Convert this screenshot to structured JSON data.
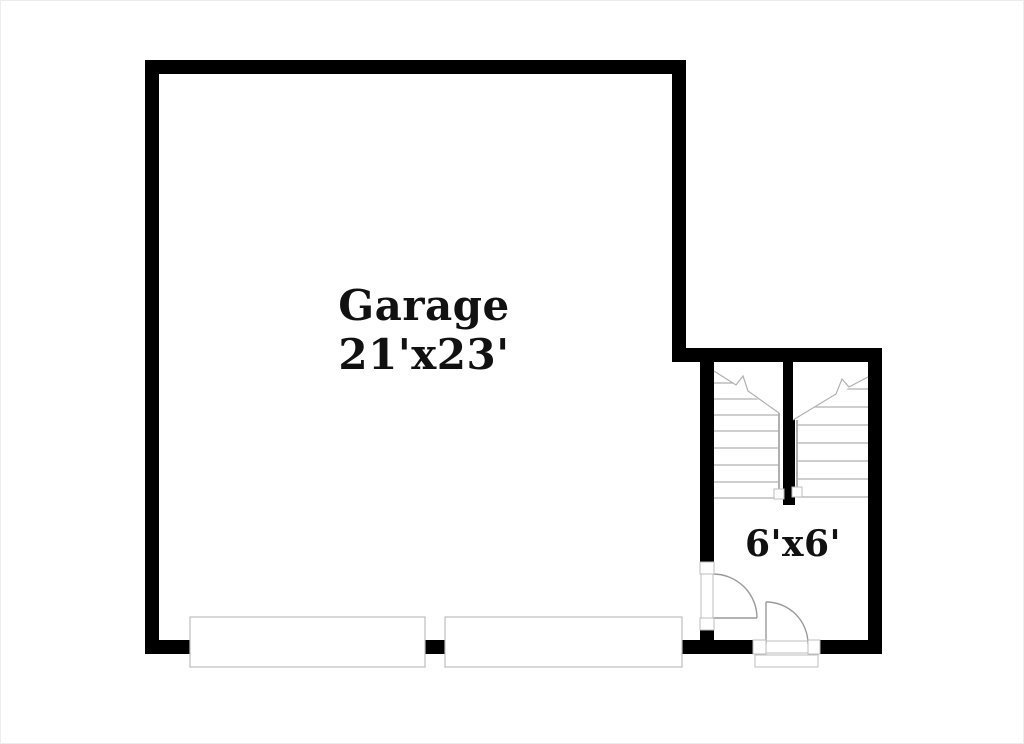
{
  "labels": {
    "garage": {
      "name": "Garage",
      "dimensions": "21'x23'"
    },
    "landing": {
      "dimensions": "6'x6'"
    }
  },
  "colors": {
    "background": "#ffffff",
    "wall": "#000000",
    "stair_line": "#b0b0b0",
    "door_line": "#9a9a9a",
    "fixture_outline": "#bdbdbd",
    "text": "#111111"
  },
  "elements": {
    "stair_flights": 2,
    "swing_doors": 2,
    "garage_door_panels": 2,
    "exterior_stoop": 1
  }
}
